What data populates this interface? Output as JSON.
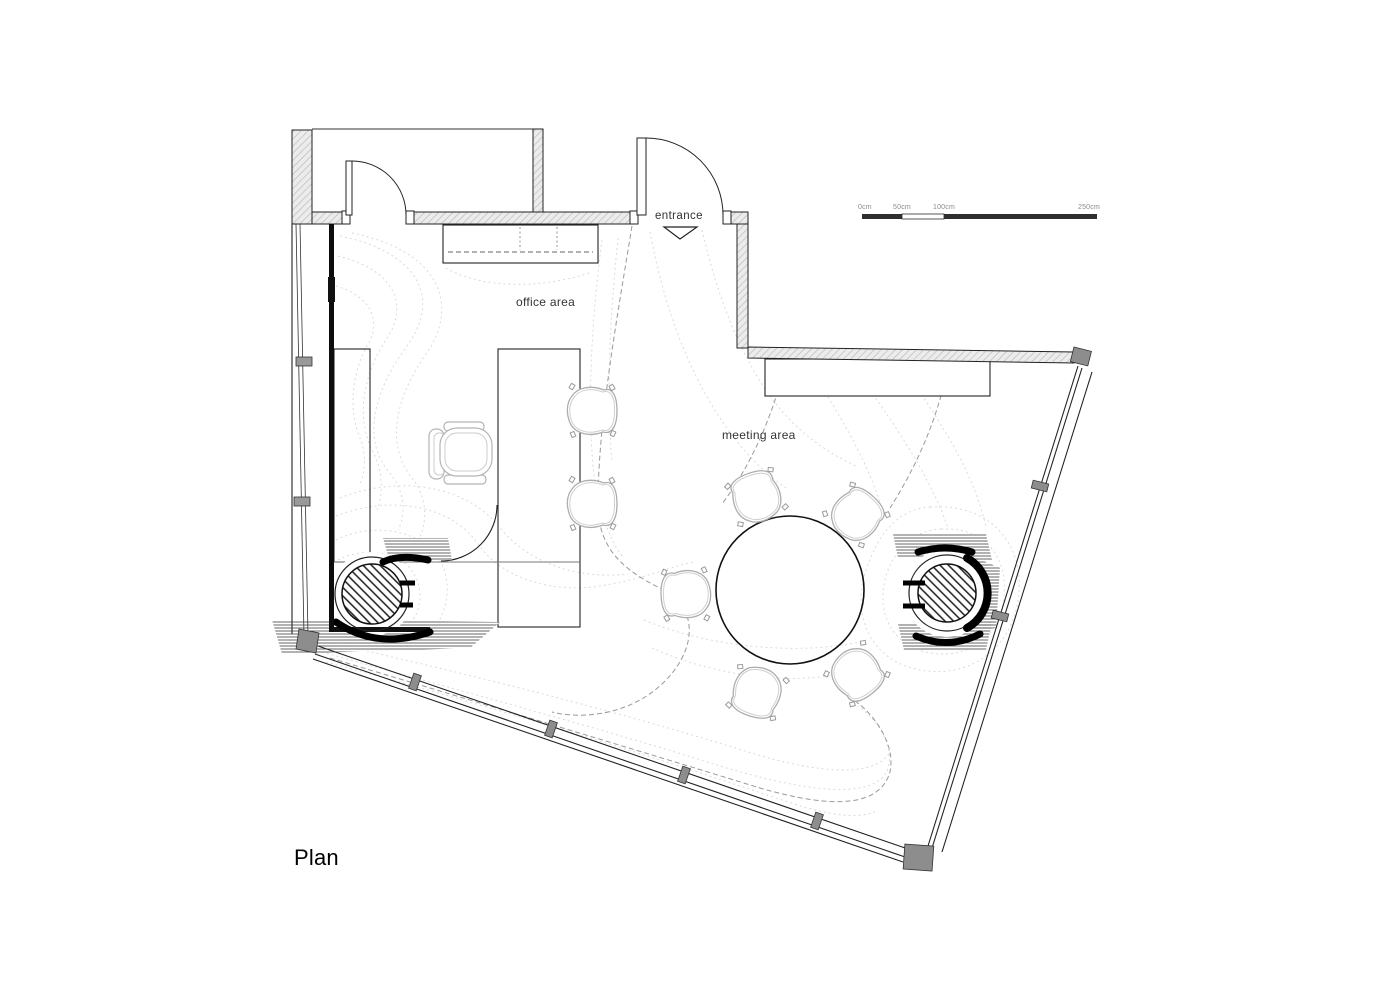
{
  "page": {
    "title": "Plan"
  },
  "labels": {
    "entrance": "entrance",
    "office_area": "office area",
    "meeting_area": "meeting area"
  },
  "scale_bar": {
    "ticks": [
      "0cm",
      "50cm",
      "100cm",
      "250cm"
    ]
  },
  "colors": {
    "background": "#ffffff",
    "wall_fill": "#ececec",
    "line": "#1a1a1a",
    "contour_light": "#dadada",
    "contour_dashed": "#999999",
    "column_gray": "#8d8d8d",
    "furniture_gray": "#b0b0b0",
    "scale_bar_dark": "#2f2f2f"
  }
}
